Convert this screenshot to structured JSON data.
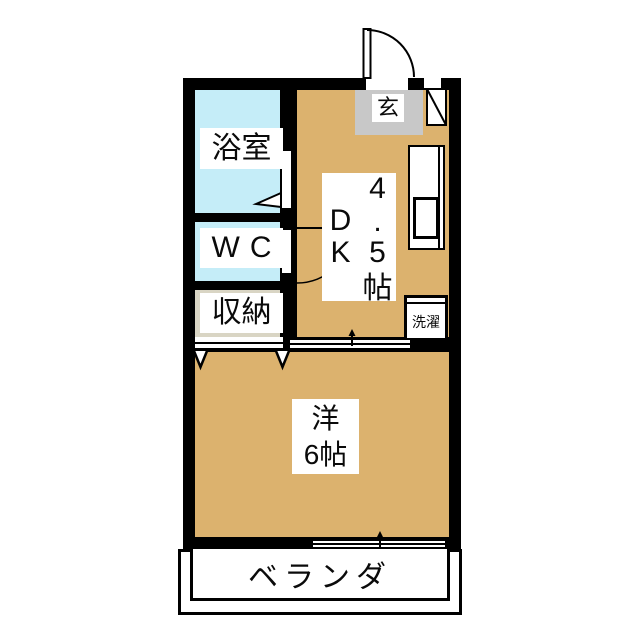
{
  "document": {
    "type": "apartment-floor-plan"
  },
  "labels": {
    "bathroom": "浴室",
    "wc": "WC",
    "storage": "収納",
    "entrance": "玄",
    "laundry": "洗濯",
    "western_line1": "洋",
    "western_line2": "6帖",
    "veranda": "ベランダ",
    "dk": {
      "r1c2": "4",
      "r2c1": "D",
      "r2c2": ".",
      "r3c1": "K",
      "r3c2": "5",
      "r4c2": "帖"
    }
  },
  "colors": {
    "wall": "#000000",
    "tan": "#DCB26E",
    "blue": "#C5EDF8",
    "gray": "#C8C8C8",
    "beige": "#D9D5C4",
    "paper": "#FFFFFF"
  }
}
